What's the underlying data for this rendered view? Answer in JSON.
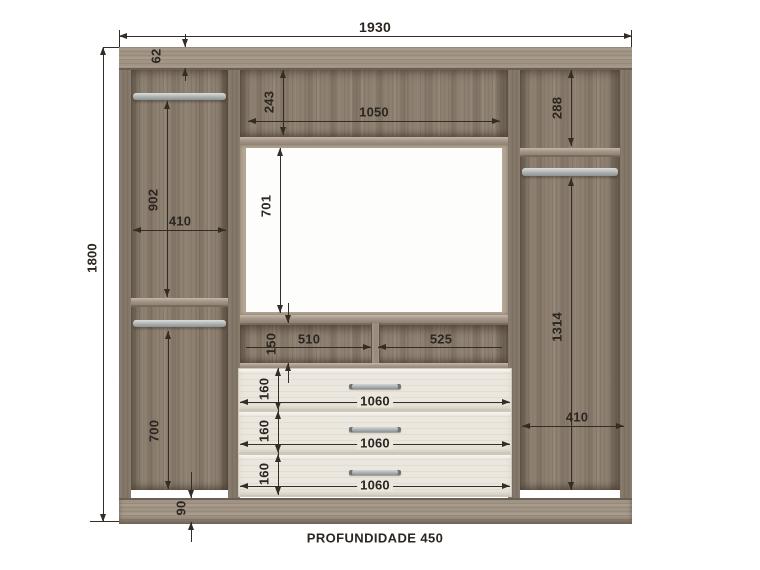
{
  "diagram": {
    "type": "furniture-technical-drawing",
    "footer_label": "PROFUNDIDADE 450",
    "dimensions": {
      "overall_width": "1930",
      "overall_height": "1800",
      "top_panel_offset": "62",
      "top_niche_height": "243",
      "top_niche_width": "1050",
      "right_upper_height": "288",
      "left_upper_height": "902",
      "left_compartment_width": "410",
      "tv_opening_height": "701",
      "right_lower_height": "1314",
      "middle_niche_height": "150",
      "middle_niche_left_width": "510",
      "middle_niche_right_width": "525",
      "left_lower_height": "700",
      "right_lower_width": "410",
      "base_height": "90"
    },
    "drawers": [
      {
        "height_label": "160",
        "width_label": "1060"
      },
      {
        "height_label": "160",
        "width_label": "1060"
      },
      {
        "height_label": "160",
        "width_label": "1060"
      }
    ],
    "colors": {
      "wood": "#8d8071",
      "wood_dark": "#5f5449",
      "wood_light": "#a29485",
      "drawer_front": "#ebe7de",
      "rod_metal": "#b0b5b4",
      "dimension_ink": "#332d26",
      "background": "#ffffff"
    }
  }
}
